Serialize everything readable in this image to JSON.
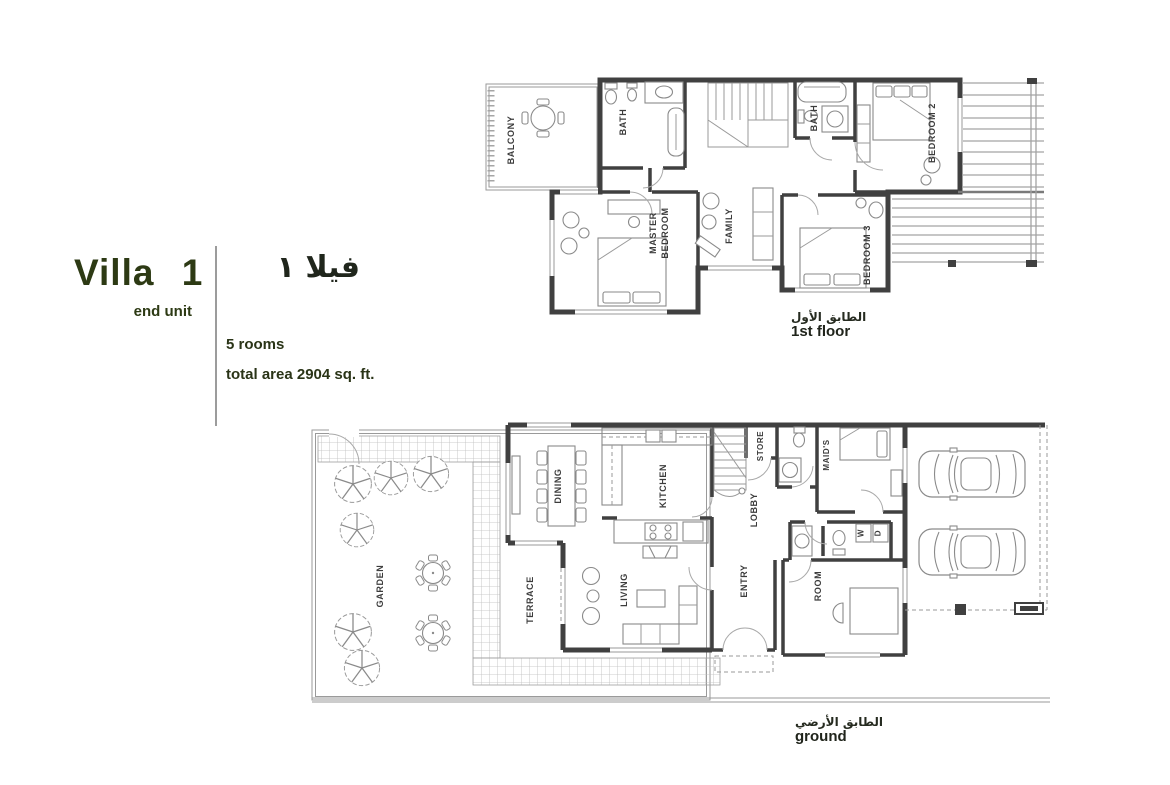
{
  "theme": {
    "accent_color": "#2d3a14",
    "wall_color": "#404040",
    "furniture_line_color": "#8a8a8a"
  },
  "info": {
    "title": "Villa 1",
    "subtitle": "end unit",
    "title_ar": "فيلا ١",
    "rooms_count": "5 rooms",
    "total_area": "total area 2904 sq. ft."
  },
  "first_floor": {
    "caption_ar": "الطابق الأول",
    "caption_en": "1st floor",
    "rooms": {
      "balcony": "BALCONY",
      "bath_left": "BATH",
      "master_line1": "MASTER",
      "master_line2": "BEDROOM",
      "family": "FAMILY",
      "bath_right": "BATH",
      "bedroom2": "BEDROOM 2",
      "bedroom3": "BEDROOM 3"
    }
  },
  "ground_floor": {
    "caption_ar": "الطابق الأرضي",
    "caption_en": "ground",
    "rooms": {
      "garden": "GARDEN",
      "terrace": "TERRACE",
      "dining": "DINING",
      "kitchen": "KITCHEN",
      "living": "LIVING",
      "store": "STORE",
      "lobby": "LOBBY",
      "maids": "MAID'S",
      "entry": "ENTRY",
      "room": "ROOM",
      "washer": "W",
      "dryer": "D"
    }
  }
}
